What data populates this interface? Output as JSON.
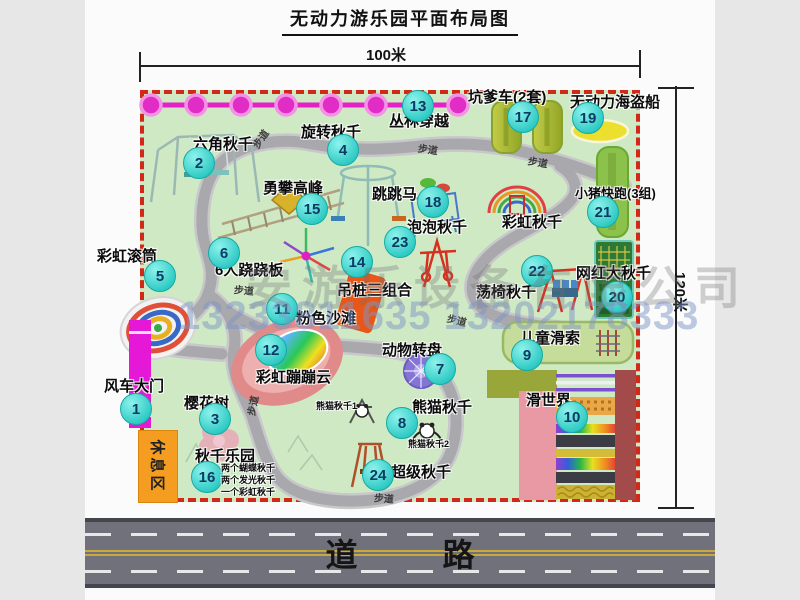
{
  "title": "无动力游乐园平面布局图",
  "dim_width": "100米",
  "dim_height": "120米",
  "road": "道 路",
  "rest_area": "休息区",
  "path_label": "步道",
  "watermark_company": "安游乐设备有限公司",
  "watermark_phone": "13233811635 13202178333",
  "colors": {
    "park_green": "#cfe9c5",
    "border_red": "#d22818",
    "badge_cyan": "#2cc9c3",
    "zipline_magenta": "#e620c8",
    "gate_magenta": "#e518d8",
    "rest_orange": "#f59d20",
    "road_gray": "#71717b"
  },
  "attractions": [
    {
      "num": "1",
      "label": "风车大门"
    },
    {
      "num": "2",
      "label": "六角秋千"
    },
    {
      "num": "3",
      "label": "樱花树"
    },
    {
      "num": "4",
      "label": "旋转秋千"
    },
    {
      "num": "5",
      "label": "彩虹滚筒"
    },
    {
      "num": "6",
      "label": "6人跷跷板"
    },
    {
      "num": "7",
      "label": "动物转盘"
    },
    {
      "num": "8",
      "label": "熊猫秋千"
    },
    {
      "num": "9",
      "label": "儿童滑索"
    },
    {
      "num": "10",
      "label": "滑世界"
    },
    {
      "num": "11",
      "label": "粉色沙滩"
    },
    {
      "num": "12",
      "label": "彩虹蹦蹦云"
    },
    {
      "num": "13",
      "label": "丛林穿越"
    },
    {
      "num": "14",
      "label": "吊桩三组合"
    },
    {
      "num": "15",
      "label": "勇攀高峰"
    },
    {
      "num": "16",
      "label": "秋千乐园"
    },
    {
      "num": "17",
      "label": "坑爹车(2套)"
    },
    {
      "num": "18",
      "label": "跳跳马"
    },
    {
      "num": "19",
      "label": "无动力海盗船"
    },
    {
      "num": "20",
      "label": "网红大秋千"
    },
    {
      "num": "21",
      "label": "小猪快跑(3组)"
    },
    {
      "num": "22",
      "label": "荡椅秋千"
    },
    {
      "num": "23",
      "label": "泡泡秋千"
    },
    {
      "num": "24",
      "label": "超级秋千"
    }
  ],
  "extra_labels": [
    "彩虹秋千",
    "熊猫秋千1",
    "熊猫秋千2",
    "两个蝴蝶秋千",
    "两个发光秋千",
    "一个彩虹秋千"
  ]
}
